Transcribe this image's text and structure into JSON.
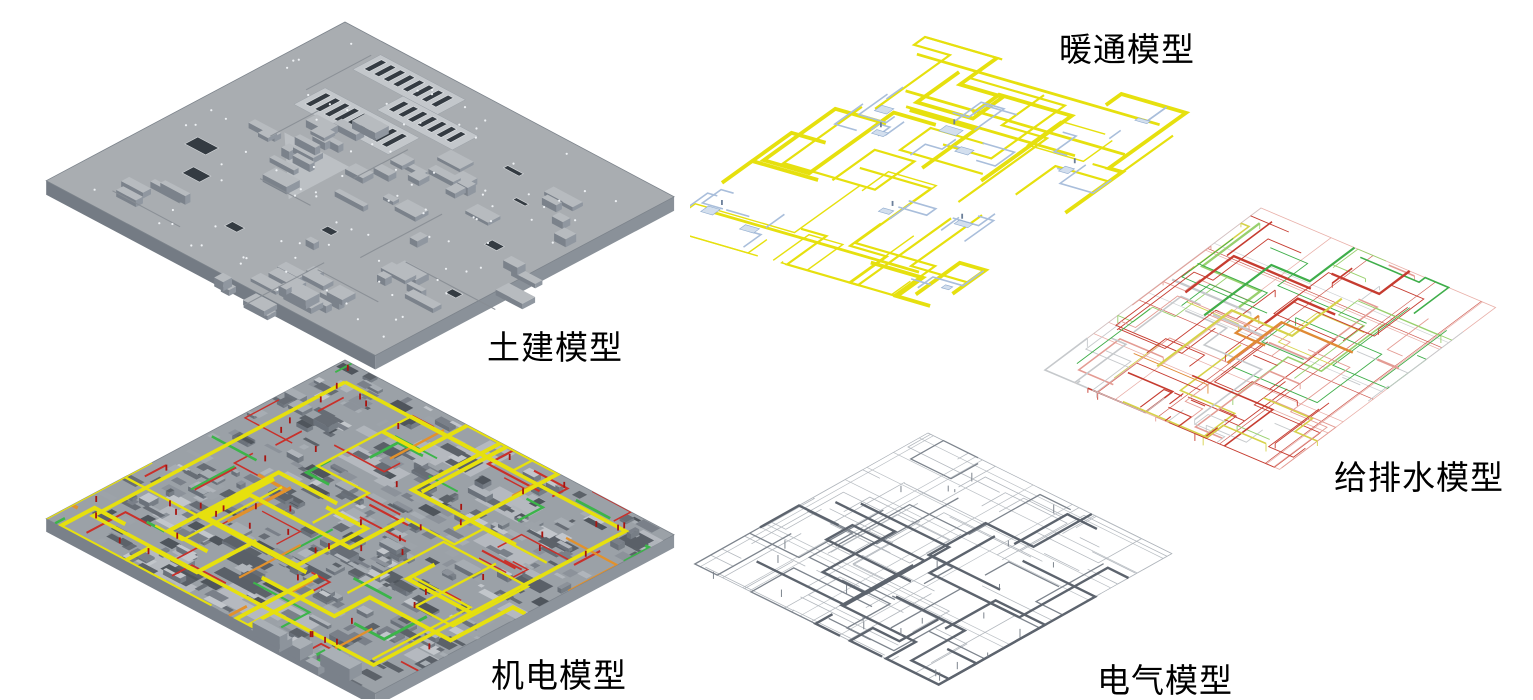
{
  "models": [
    {
      "id": "civil",
      "label": "土建模型"
    },
    {
      "id": "mep",
      "label": "机电模型"
    },
    {
      "id": "hvac",
      "label": "暖通模型"
    },
    {
      "id": "plumbing",
      "label": "给排水模型"
    },
    {
      "id": "electrical",
      "label": "电气模型"
    }
  ],
  "colors": {
    "background": "#ffffff",
    "label_text": "#000000",
    "civil_top": "#a9adb1",
    "civil_top_light": "#bcc0c4",
    "civil_side": "#8a9199",
    "civil_side_dark": "#747b84",
    "civil_edge": "#7c838b",
    "civil_hole": "#343b42",
    "civil_dot": "#eef1f4",
    "mep_base": "#9ba1a7",
    "pipe_yellow": "#e6e00e",
    "pipe_orange": "#e2912c",
    "pipe_red": "#c9302a",
    "pipe_green": "#3cb44a",
    "hvac_blue": "#a9bedb",
    "hvac_blue_fill": "#d3dfee",
    "plumb_red": "#c63c30",
    "plumb_pink": "#e49c94",
    "plumb_green": "#3fae4a",
    "plumb_lightgreen": "#98d06e",
    "plumb_yellow": "#d6d24a",
    "plumb_orange": "#e08a35",
    "plumb_gray": "#c6c9cc",
    "elec_dark": "#5d646e",
    "elec_light": "#b3b8be"
  }
}
